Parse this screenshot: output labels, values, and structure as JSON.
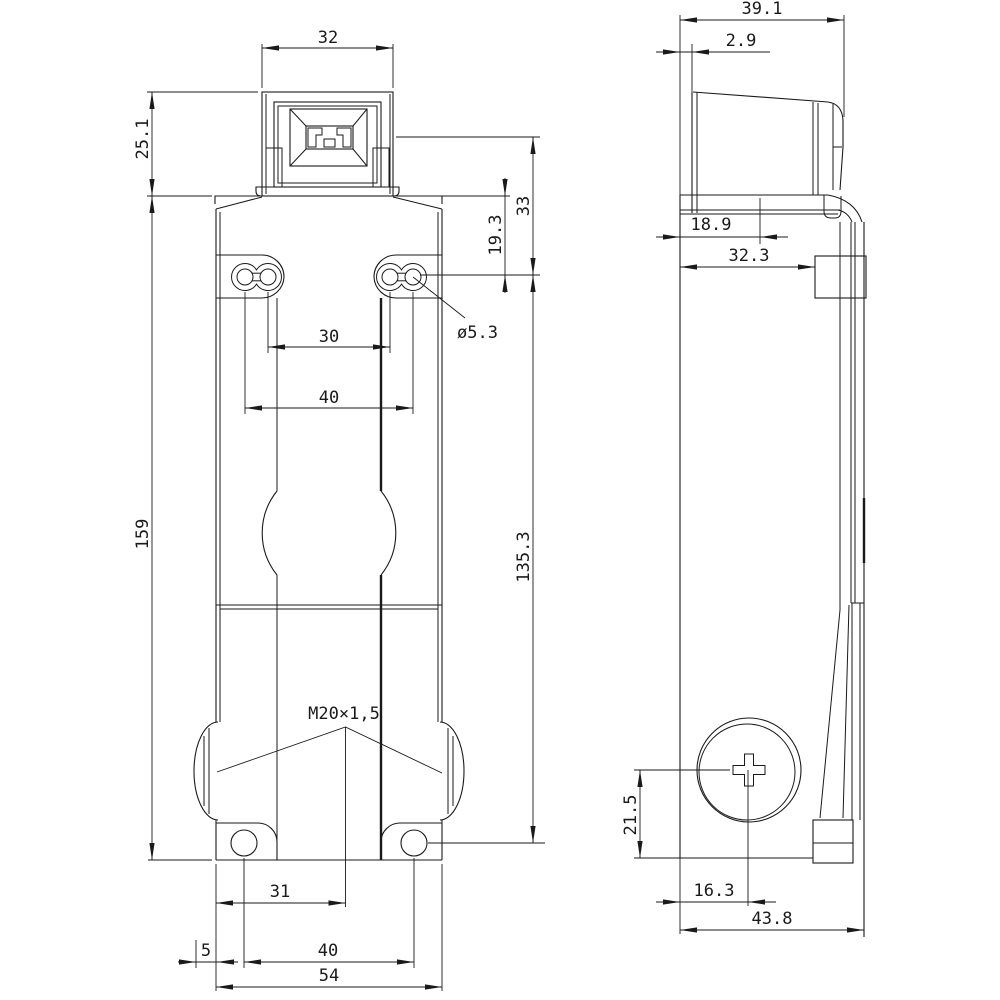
{
  "page": {
    "background": "#ffffff",
    "line_color": "#1a1a1a",
    "description": "two-view dimensioned technical drawing of a safety position switch"
  },
  "dims": {
    "head_width": "32",
    "head_height": "25.1",
    "axis_to_slot": "33",
    "top_to_slot": "19.3",
    "slot_dia": "ø5.3",
    "slot_span_inner": "30",
    "slot_span_outer": "40",
    "body_height": "159",
    "slot_to_hole": "135.3",
    "thread": "M20×1,5",
    "hole_to_center": "31",
    "gland_protrusion": "5",
    "hole_span": "40",
    "body_width": "54",
    "depth_with_head": "39.1",
    "head_setback": "2.9",
    "front_to_axis": "18.9",
    "front_to_clamp": "32.3",
    "gland_center_height": "21.5",
    "front_to_gland": "16.3",
    "depth_total": "43.8"
  }
}
